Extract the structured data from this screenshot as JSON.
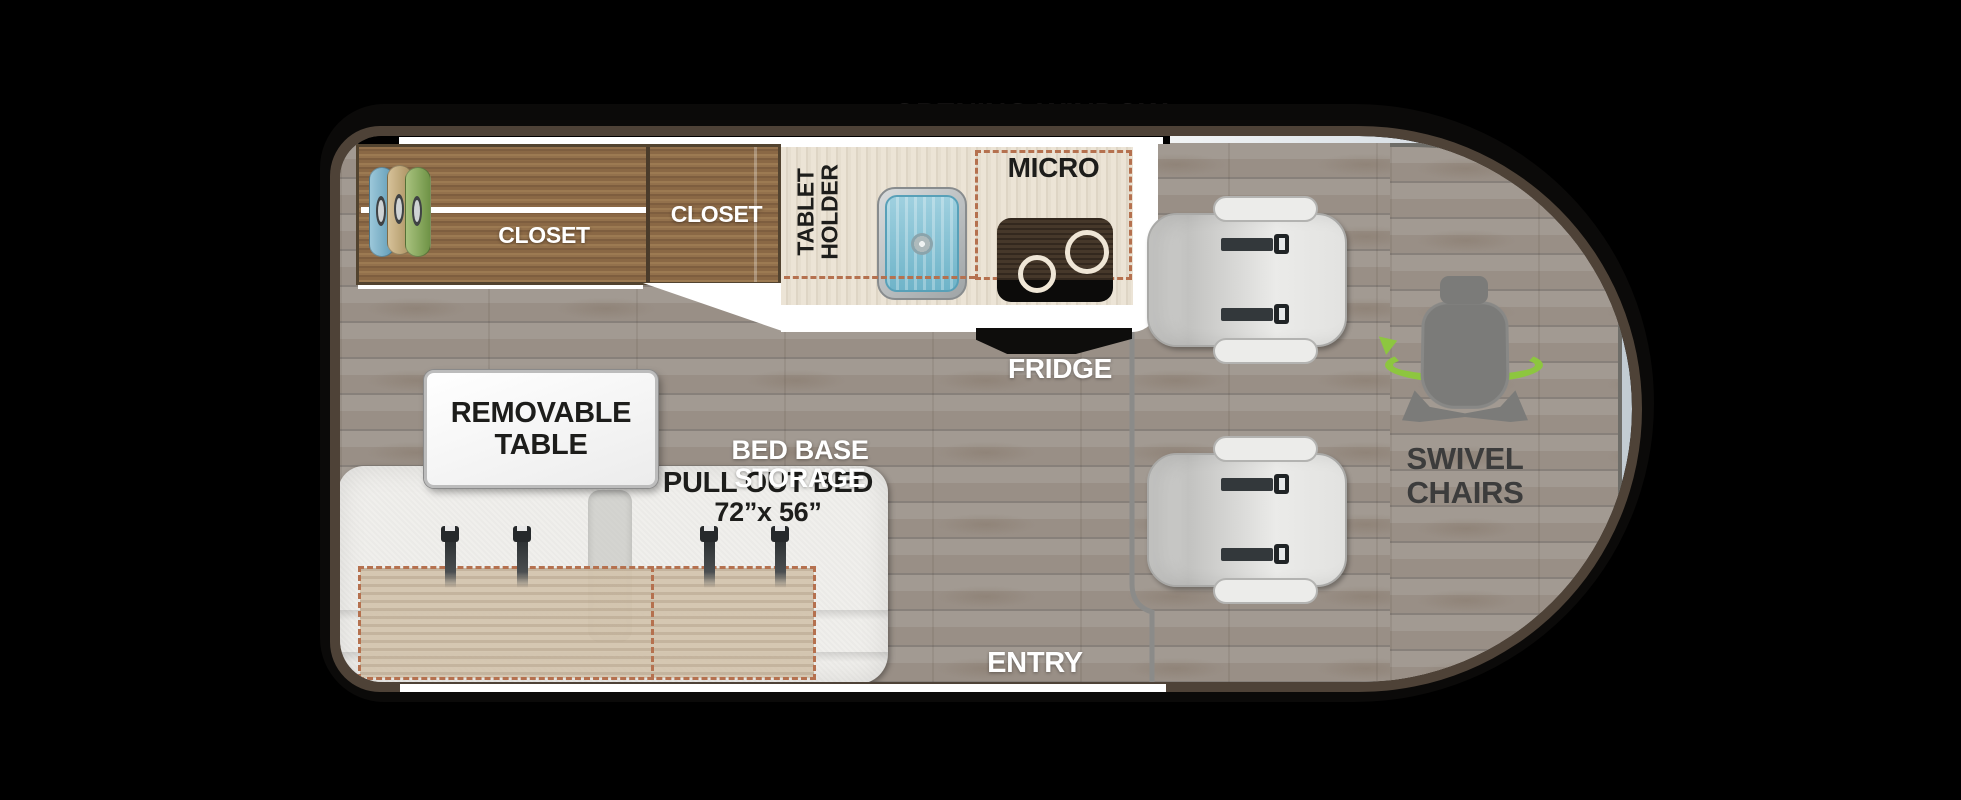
{
  "van": {
    "window_label": "OPENING WINDOW",
    "closet": {
      "left_label": "CLOSET",
      "right_label": "CLOSET"
    },
    "kitchen": {
      "tablet_holder_line1": "TABLET",
      "tablet_holder_line2": "HOLDER",
      "micro_label": "MICRO",
      "fridge_label": "FRIDGE"
    },
    "lounge": {
      "table_sign_line1": "REMOVABLE",
      "table_sign_line2": "TABLE",
      "bed_storage_label": "BED BASE STORAGE",
      "pull_out_bed_label": "PULL OUT BED",
      "bed_size_label": "72”x 56”"
    },
    "entry_label": "ENTRY",
    "cab": {
      "swivel_line1": "SWIVEL",
      "swivel_line2": "CHAIRS",
      "seat_count": "2"
    },
    "colors": {
      "border_brown": "#4e4237",
      "floor_gray": "#9d958d",
      "closet_wood": "#8a6747",
      "counter_cream": "#e7dfd2",
      "dashed_accent": "#b5714f",
      "swivel_green": "#8dc63f",
      "sink_blue": "#7ec0d2",
      "label_dark": "#1d1d1b",
      "label_white": "#ffffff"
    }
  }
}
